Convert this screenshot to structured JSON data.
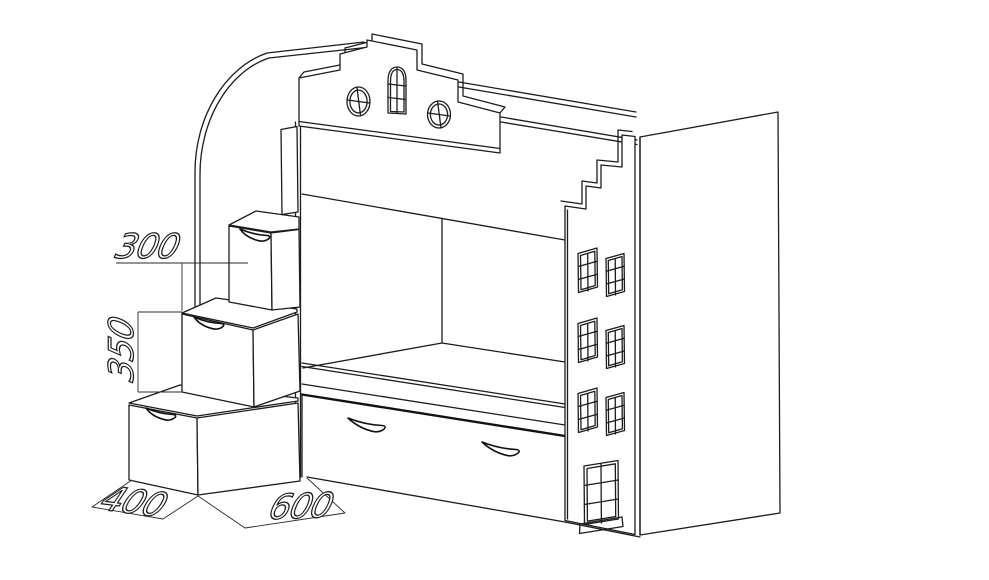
{
  "drawing": {
    "title": "bunk-bed-house-technical-drawing",
    "background": "#ffffff",
    "stroke_color": "#1c1c1c",
    "dimensions": {
      "step_top_depth_mm": "300",
      "step_rise_mm": "350",
      "step_base_depth_mm": "400",
      "bed_width_mm": "600"
    }
  }
}
